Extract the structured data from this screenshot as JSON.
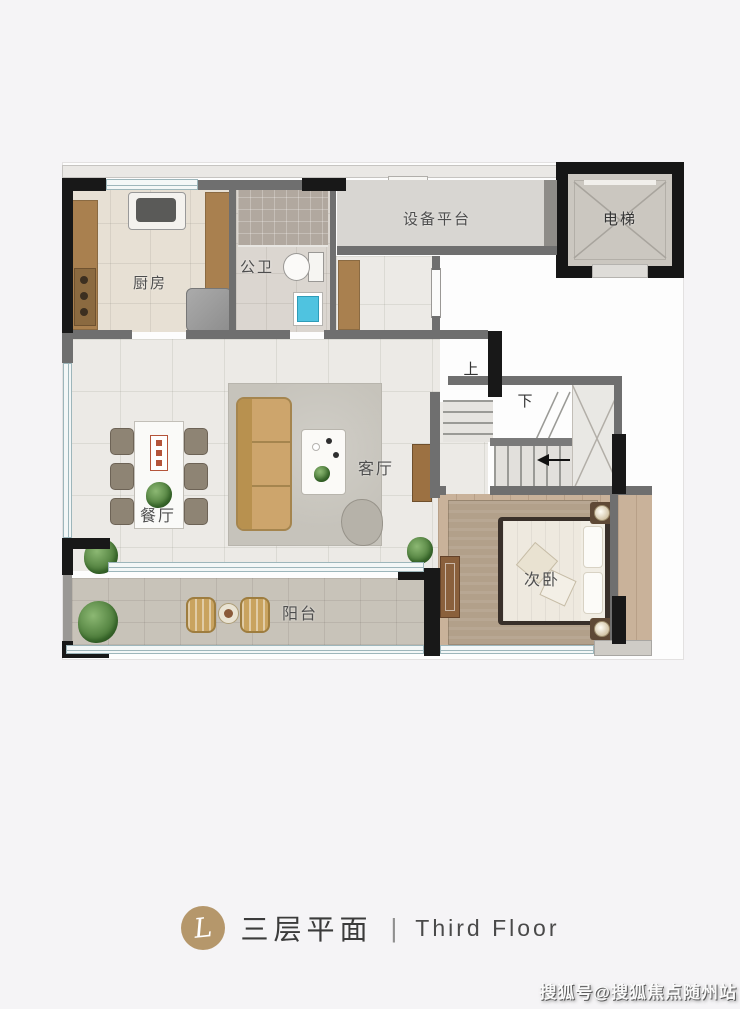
{
  "page": {
    "background": "#f5f4f6"
  },
  "plan": {
    "rooms": {
      "kitchen": {
        "label": "厨房"
      },
      "bathroom": {
        "label": "公卫"
      },
      "equipment_platform": {
        "label": "设备平台"
      },
      "elevator": {
        "label": "电梯"
      },
      "living": {
        "label": "客厅"
      },
      "dining": {
        "label": "餐厅"
      },
      "bedroom": {
        "label": "次卧"
      },
      "balcony": {
        "label": "阳台"
      }
    },
    "stairs": {
      "up_label": "上",
      "down_label": "下"
    },
    "colors": {
      "wall_black": "#181818",
      "wall_gray": "#6f6f6f",
      "window_blue": "#9db6bb",
      "wood_brown": "#a9804f",
      "sofa_tan": "#cda56c",
      "basin_blue": "#4fc3e0",
      "marble_floor": "#eceae6",
      "bedroom_wood": "#c9b29a",
      "balcony_paver": "#c8c3b9",
      "logo_gold": "#b5976b"
    }
  },
  "footer": {
    "logo_letter": "L",
    "title_cn": "三层平面",
    "separator": "|",
    "title_en": "Third Floor"
  },
  "watermark": {
    "text": "搜狐号@搜狐焦点随州站"
  }
}
